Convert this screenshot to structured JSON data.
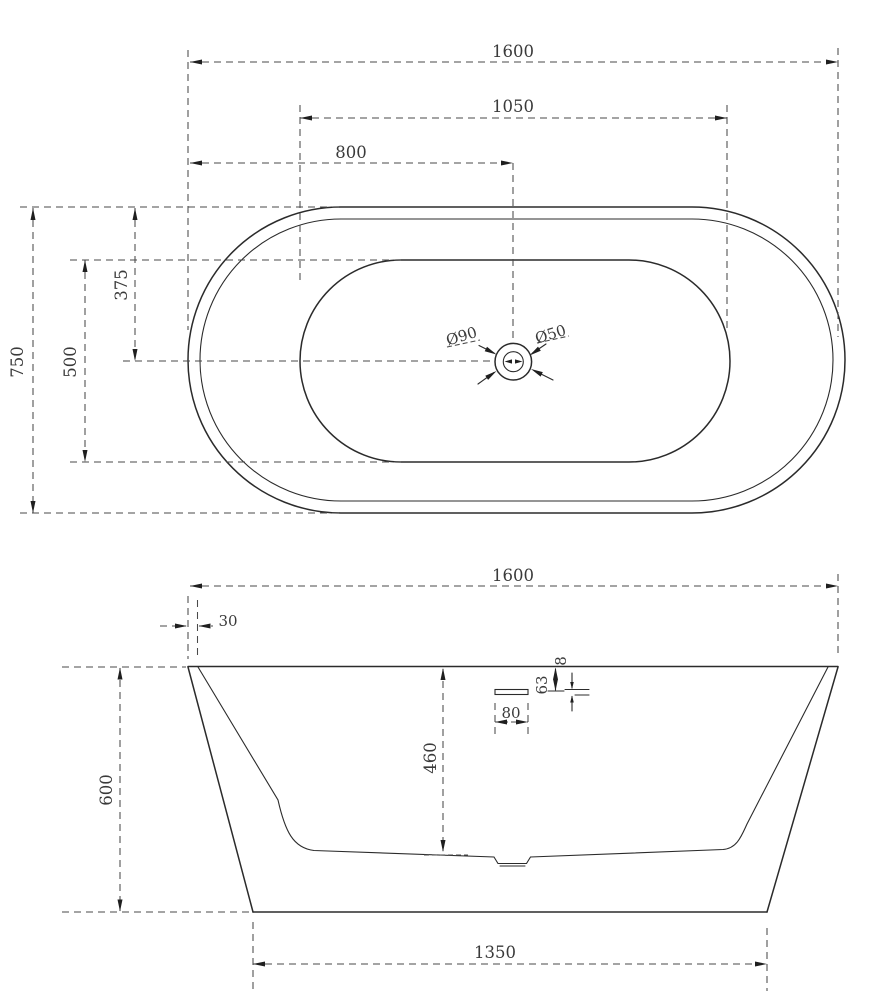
{
  "drawing_title": "Freestanding bathtub dimension drawing",
  "top_view": {
    "overall_length": "1600",
    "basin_length": "1050",
    "drain_center_from_left": "800",
    "overall_width": "750",
    "basin_width": "500",
    "centerline_offset": "375",
    "drain_outer_diameter": "Ø90",
    "drain_inner_diameter": "Ø50"
  },
  "side_view": {
    "overall_length": "1600",
    "rim_thickness": "30",
    "overall_height": "600",
    "inner_depth": "460",
    "overflow_drop": "63",
    "overflow_slot_thickness": "8",
    "overflow_slot_width": "80",
    "base_length": "1350"
  }
}
